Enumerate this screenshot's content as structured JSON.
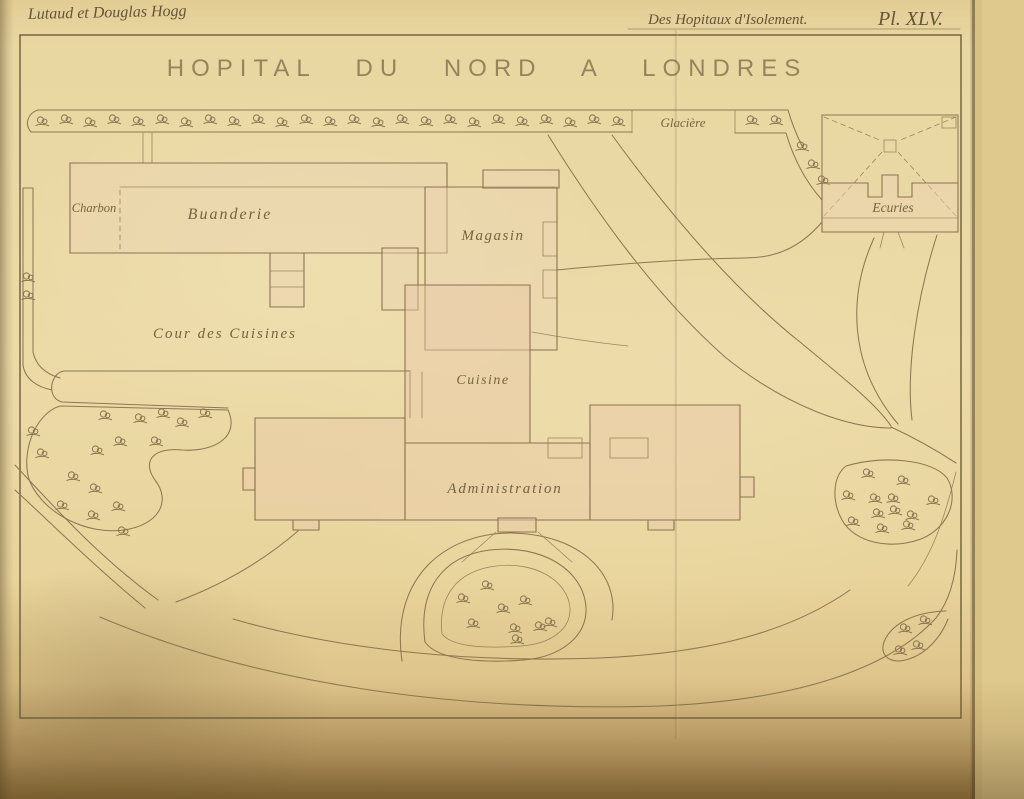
{
  "header": {
    "authors": "Lutaud et Douglas Hogg",
    "series": "Des Hopitaux d'Isolement.",
    "plate": "Pl. XLV."
  },
  "title": "HOPITAL DU NORD A LONDRES",
  "labels": {
    "glaciere": "Glacière",
    "charbon": "Charbon",
    "buanderie": "Buanderie",
    "magasin": "Magasin",
    "ecuries": "Ecuries",
    "cour_des_cuisines": "Cour des Cuisines",
    "cuisine": "Cuisine",
    "administration": "Administration"
  },
  "colors": {
    "paper": "#e9d7a2",
    "ink": "#8a7550",
    "building_fill": "#ecd2b2",
    "stamp_ink": "#8f7c55"
  }
}
